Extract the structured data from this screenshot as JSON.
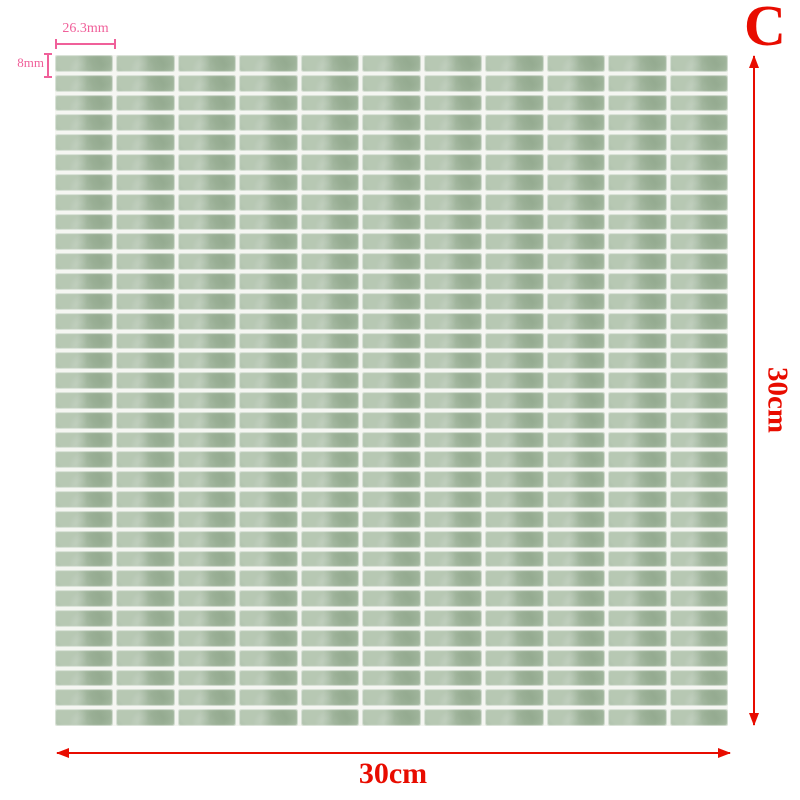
{
  "product_diagram": {
    "variant_label": "C",
    "sheet_width_label": "30cm",
    "sheet_height_label": "30cm",
    "tile_width_label": "26.3mm",
    "tile_height_label": "8mm"
  },
  "grid": {
    "columns": 11,
    "rows": 34
  },
  "colors": {
    "tile_green": "#a9bda5",
    "tile_texture_dark": "#768f71",
    "grout_white": "#f5f6f2",
    "dimension_red": "#e80c00",
    "annotation_pink": "#f0609a",
    "background": "#ffffff"
  }
}
